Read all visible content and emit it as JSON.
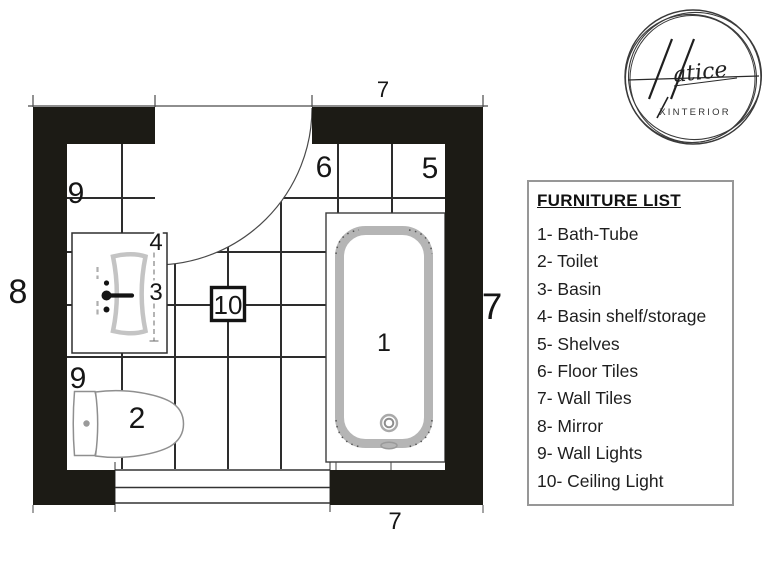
{
  "plan": {
    "dimension_labels": {
      "top": "7",
      "right": "7",
      "bottom": "7",
      "left": "8"
    },
    "item_labels": {
      "bath_tube": "1",
      "toilet": "2",
      "basin": "3",
      "basin_shelf": "4",
      "shelves": "5",
      "floor_tiles": "6",
      "wall_light_upper": "9",
      "wall_light_lower": "9",
      "ceiling_light": "10"
    },
    "colors": {
      "wall": "#1c1b15",
      "grid_line": "#2d2d2d",
      "tub_gray": "#b5b5b5"
    }
  },
  "furniture_list": {
    "title": "FURNITURE LIST",
    "items": [
      "1- Bath-Tube",
      "2- Toilet",
      "3- Basin",
      "4- Basin shelf/storage",
      "5- Shelves",
      "6- Floor Tiles",
      "7- Wall Tiles",
      "8- Mirror",
      "9- Wall Lights",
      "10- Ceiling Light"
    ]
  },
  "logo": {
    "brand_name": "Hatice",
    "brand_script_text": "atice",
    "subtitle": "XINTERIOR"
  }
}
